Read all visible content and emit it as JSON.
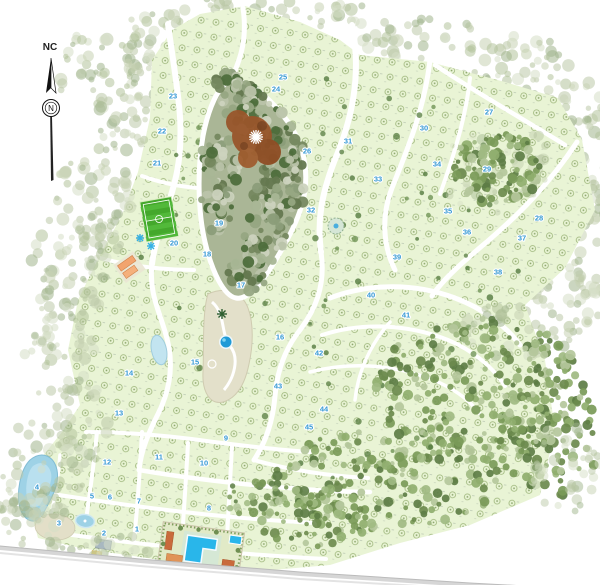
{
  "compass": {
    "label": "NC",
    "needle": "N"
  },
  "plan": {
    "label_color": "#3598d4",
    "block_fill": "#e9f4d5",
    "road_color": "#ffffff",
    "block_labels": [
      {
        "n": "1",
        "x": 137,
        "y": 529
      },
      {
        "n": "2",
        "x": 104,
        "y": 533
      },
      {
        "n": "3",
        "x": 59,
        "y": 523
      },
      {
        "n": "4",
        "x": 37,
        "y": 487
      },
      {
        "n": "5",
        "x": 92,
        "y": 496
      },
      {
        "n": "6",
        "x": 110,
        "y": 497
      },
      {
        "n": "7",
        "x": 139,
        "y": 501
      },
      {
        "n": "8",
        "x": 209,
        "y": 508
      },
      {
        "n": "9",
        "x": 226,
        "y": 438
      },
      {
        "n": "10",
        "x": 204,
        "y": 463
      },
      {
        "n": "11",
        "x": 159,
        "y": 457
      },
      {
        "n": "12",
        "x": 107,
        "y": 462
      },
      {
        "n": "13",
        "x": 119,
        "y": 413
      },
      {
        "n": "14",
        "x": 129,
        "y": 373
      },
      {
        "n": "15",
        "x": 195,
        "y": 362
      },
      {
        "n": "16",
        "x": 280,
        "y": 337
      },
      {
        "n": "17",
        "x": 241,
        "y": 285
      },
      {
        "n": "18",
        "x": 207,
        "y": 254
      },
      {
        "n": "19",
        "x": 219,
        "y": 223
      },
      {
        "n": "20",
        "x": 174,
        "y": 243
      },
      {
        "n": "21",
        "x": 157,
        "y": 163
      },
      {
        "n": "22",
        "x": 162,
        "y": 131
      },
      {
        "n": "23",
        "x": 173,
        "y": 96
      },
      {
        "n": "24",
        "x": 276,
        "y": 89
      },
      {
        "n": "25",
        "x": 283,
        "y": 77
      },
      {
        "n": "26",
        "x": 307,
        "y": 151
      },
      {
        "n": "27",
        "x": 489,
        "y": 112
      },
      {
        "n": "28",
        "x": 539,
        "y": 218
      },
      {
        "n": "29",
        "x": 487,
        "y": 169
      },
      {
        "n": "30",
        "x": 424,
        "y": 128
      },
      {
        "n": "31",
        "x": 348,
        "y": 141
      },
      {
        "n": "32",
        "x": 311,
        "y": 210
      },
      {
        "n": "33",
        "x": 378,
        "y": 179
      },
      {
        "n": "34",
        "x": 437,
        "y": 164
      },
      {
        "n": "35",
        "x": 448,
        "y": 211
      },
      {
        "n": "36",
        "x": 467,
        "y": 232
      },
      {
        "n": "37",
        "x": 522,
        "y": 238
      },
      {
        "n": "38",
        "x": 498,
        "y": 272
      },
      {
        "n": "39",
        "x": 397,
        "y": 257
      },
      {
        "n": "40",
        "x": 371,
        "y": 295
      },
      {
        "n": "41",
        "x": 406,
        "y": 315
      },
      {
        "n": "42",
        "x": 319,
        "y": 353
      },
      {
        "n": "43",
        "x": 278,
        "y": 386
      },
      {
        "n": "44",
        "x": 324,
        "y": 409
      },
      {
        "n": "45",
        "x": 309,
        "y": 427
      }
    ],
    "features": [
      {
        "name": "soccer-field",
        "color": "#44a82c"
      },
      {
        "name": "central-forest-reserve",
        "color": "#8b9d79"
      },
      {
        "name": "reserve-clearing",
        "color": "#99562b"
      },
      {
        "name": "park-round-pool",
        "color": "#1f9ad6"
      },
      {
        "name": "club-pool",
        "color": "#29b6ea"
      },
      {
        "name": "lake",
        "color": "#9ed2e6"
      },
      {
        "name": "service-buildings",
        "color": "#f2a46e"
      },
      {
        "name": "central-park",
        "color": "#e3e0ca"
      }
    ]
  }
}
